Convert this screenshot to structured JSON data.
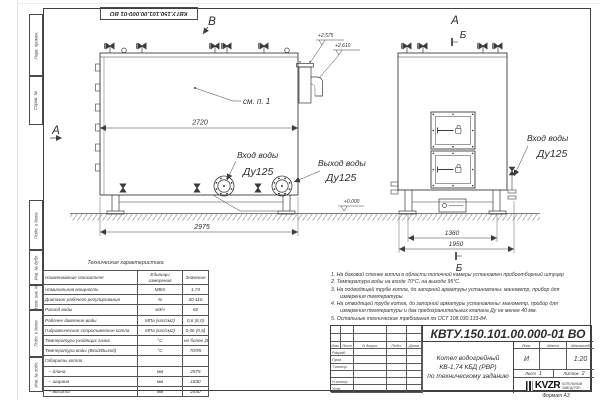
{
  "stamp": {
    "code": "КВТУ.150.101.00.000-01 ВО"
  },
  "margin_labels": [
    "Перв. примен.",
    "Справ. №",
    "Подп. и дата",
    "Инв. № дубл.",
    "Взам. инв. №",
    "Подп. и дата",
    "Инв. № подл."
  ],
  "labels": {
    "view_v": "В",
    "view_a_side": "А",
    "view_a_front": "А",
    "section_b_top": "Б",
    "section_b_bottom": "Б",
    "see_item": "см. п. 1",
    "inlet": "Вход воды",
    "inlet_dn": "Ду125",
    "outlet": "Выход воды",
    "outlet_dn": "Ду125",
    "inlet_front": "Вход воды",
    "inlet_front_dn": "Ду125",
    "elev_1": "+2.575",
    "elev_2": "+2.610",
    "elev_zero": "+0.000"
  },
  "dims": {
    "body_length": "2720",
    "overall_length": "2975",
    "support_span": "1360",
    "overall_width": "1950"
  },
  "table": {
    "title": "Техническая характеристика",
    "headers": {
      "name": "Наименование показателя",
      "unit": "Единицы измерения",
      "value": "Значение"
    },
    "rows": [
      {
        "name": "Номинальная мощность",
        "unit": "МВт",
        "value": "1,74"
      },
      {
        "name": "Диапазон рабочего регулирования",
        "unit": "%",
        "value": "40-110"
      },
      {
        "name": "Расход воды",
        "unit": "м3/ч",
        "value": "60"
      },
      {
        "name": "Рабочее давление воды",
        "unit": "МПа (кгс/см2)",
        "value": "0,6 (6,0)"
      },
      {
        "name": "Гидравлическое сопротивление котла",
        "unit": "МПа (кгс/см2)",
        "value": "0,06 (0,6)"
      },
      {
        "name": "Температура уходящих газов",
        "unit": "°С",
        "value": "не более 280"
      },
      {
        "name": "Температура воды (Вход/Выход)",
        "unit": "°С",
        "value": "70/95"
      },
      {
        "name": "Габариты котла",
        "unit": "",
        "value": ""
      },
      {
        "name": "   – длина",
        "unit": "мм",
        "value": "2975"
      },
      {
        "name": "   – ширина",
        "unit": "мм",
        "value": "1830"
      },
      {
        "name": "   – высота",
        "unit": "мм",
        "value": "2440"
      }
    ]
  },
  "notes": {
    "items": [
      "1. На боковой стенке котла в области топочной камеры установлен пробоотборный штуцер",
      "2. Температура воды на входе 70°С, на выходе 95°С.",
      "3. На подводящей трубе котла, до запорной арматуры установлены: манометр, прибор для измерения температуры.",
      "4. На отводящей трубе котла, до запорной арматуры установлены: манометр, прибор для измерения температуры и два предохранительных клапана Ду не менее 40 мм.",
      "5. Остальные технические требования по ОСТ 108.030.133-84."
    ]
  },
  "title_block": {
    "designation": "КВТУ.150.101.00.000-01 ВО",
    "doc_name": [
      "Котел водогрейный",
      "КВ-1,74 КБД (РВР)",
      "по техническому заданию"
    ],
    "cols": [
      "Изм.",
      "Лист",
      "N докум.",
      "Подп.",
      "Дата"
    ],
    "sig_rows": [
      "Разраб.",
      "Пров.",
      "Т.контр.",
      "",
      "Н.контр.",
      "Утв."
    ],
    "lit_header": "Лит.",
    "mass_header": "Масса",
    "scale_header": "Масштаб",
    "lit_value": "И",
    "scale_value": "1:20",
    "sheet_label": "Лист",
    "sheet_value": "1",
    "sheets_label": "Листов",
    "sheets_value": "2",
    "logo_text": "KVZR",
    "org_lines": [
      "КОТЕЛЬНЫЙ",
      "ЗАВОД РЭП"
    ],
    "format_label": "Формат А3"
  }
}
